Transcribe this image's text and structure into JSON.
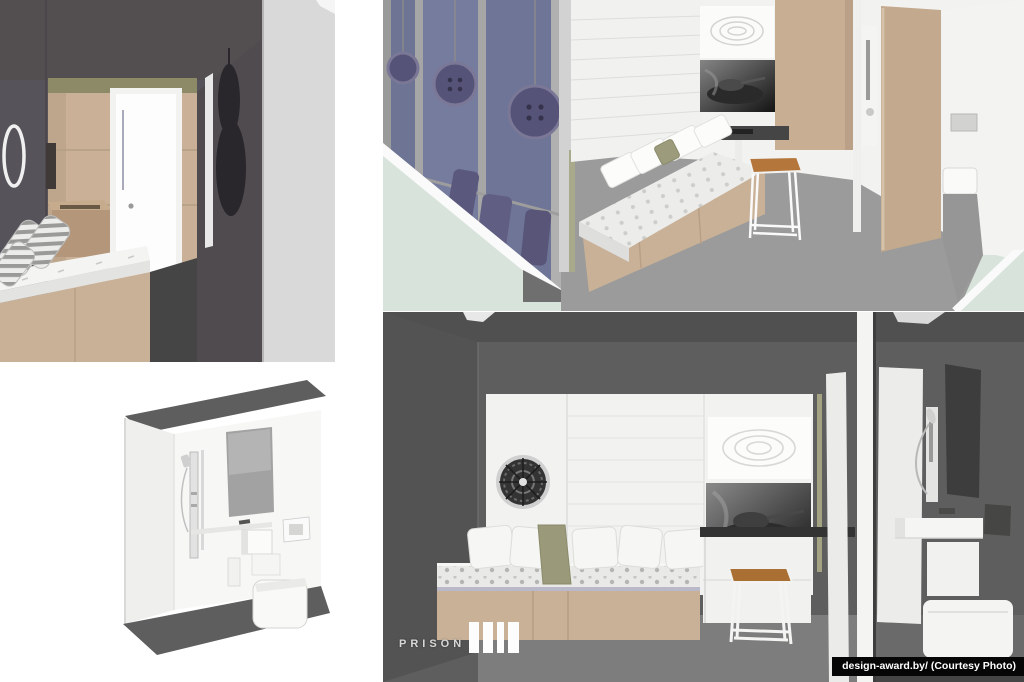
{
  "page": {
    "width_px": 1024,
    "height_px": 682,
    "background": "#ffffff"
  },
  "branding": {
    "logo_text": "PRISON"
  },
  "watermark": {
    "text": "design-award.by/ (Courtesy Photo)"
  },
  "palette": {
    "wall_dark_gray": "#575357",
    "wall_charcoal": "#4c4c4c",
    "wood_tan": "#c9b197",
    "panel_white": "#f2f2f0",
    "door_white": "#fdfdfd",
    "floor_gray": "#9b9b9b",
    "floor_mid_gray": "#7d7d7d",
    "glass_blue": "#7d83a2",
    "button_purple": "#565379",
    "mint_green": "#d8e4db",
    "stool_wood": "#b5763c",
    "pillar_light_gray": "#d9d9d9",
    "artwork_dark": "#1c1c1c",
    "mirror_gray": "#a2a2a2"
  }
}
